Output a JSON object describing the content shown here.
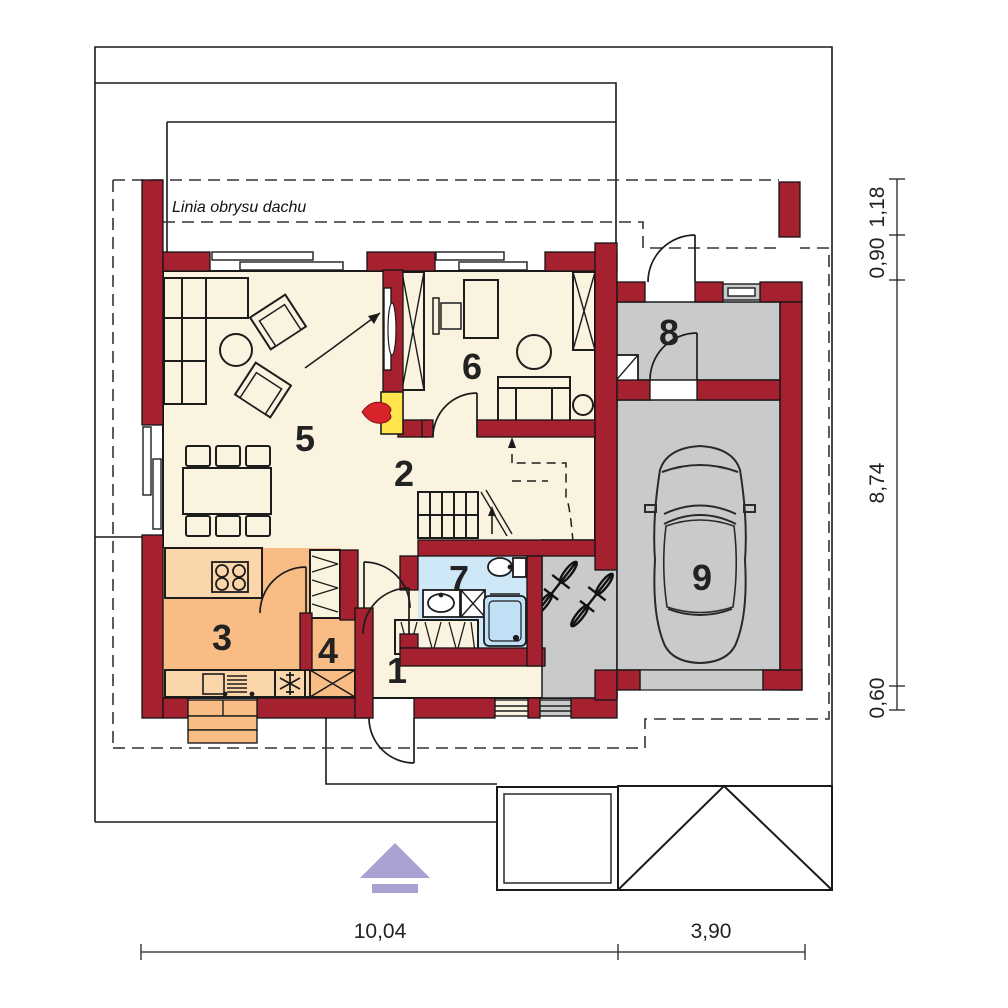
{
  "roof_label": {
    "text": "Linia obrysu dachu"
  },
  "rooms": [
    {
      "number": "1"
    },
    {
      "number": "2"
    },
    {
      "number": "3"
    },
    {
      "number": "4"
    },
    {
      "number": "5"
    },
    {
      "number": "6"
    },
    {
      "number": "7"
    },
    {
      "number": "8"
    },
    {
      "number": "9"
    }
  ],
  "dimensions": {
    "bottom": [
      {
        "label": "10,04"
      },
      {
        "label": "3,90"
      }
    ],
    "right": [
      {
        "label": "1,18"
      },
      {
        "label": "0,90"
      },
      {
        "label": "8,74"
      },
      {
        "label": "0,60"
      }
    ]
  },
  "colors": {
    "wall_red": "#a6212f",
    "floor_cream": "#faf3df",
    "kitchen_orange": "#f8bc84",
    "counter_orange": "#fbd6ab",
    "bath_blue": "#cfe8f8",
    "garage_gray": "#c9cacb",
    "fireplace_yellow": "#ffe44d",
    "flame_red": "#d8232a",
    "arrow_purple": "#a8a2d3",
    "line_black": "#1a1a1a"
  },
  "icons": [
    "fireplace-icon",
    "freezer-snowflake-icon",
    "stove-hob-icon",
    "boiler-icon",
    "car-icon",
    "bicycle-icon",
    "entrance-arrow-icon",
    "stairs-icon"
  ]
}
